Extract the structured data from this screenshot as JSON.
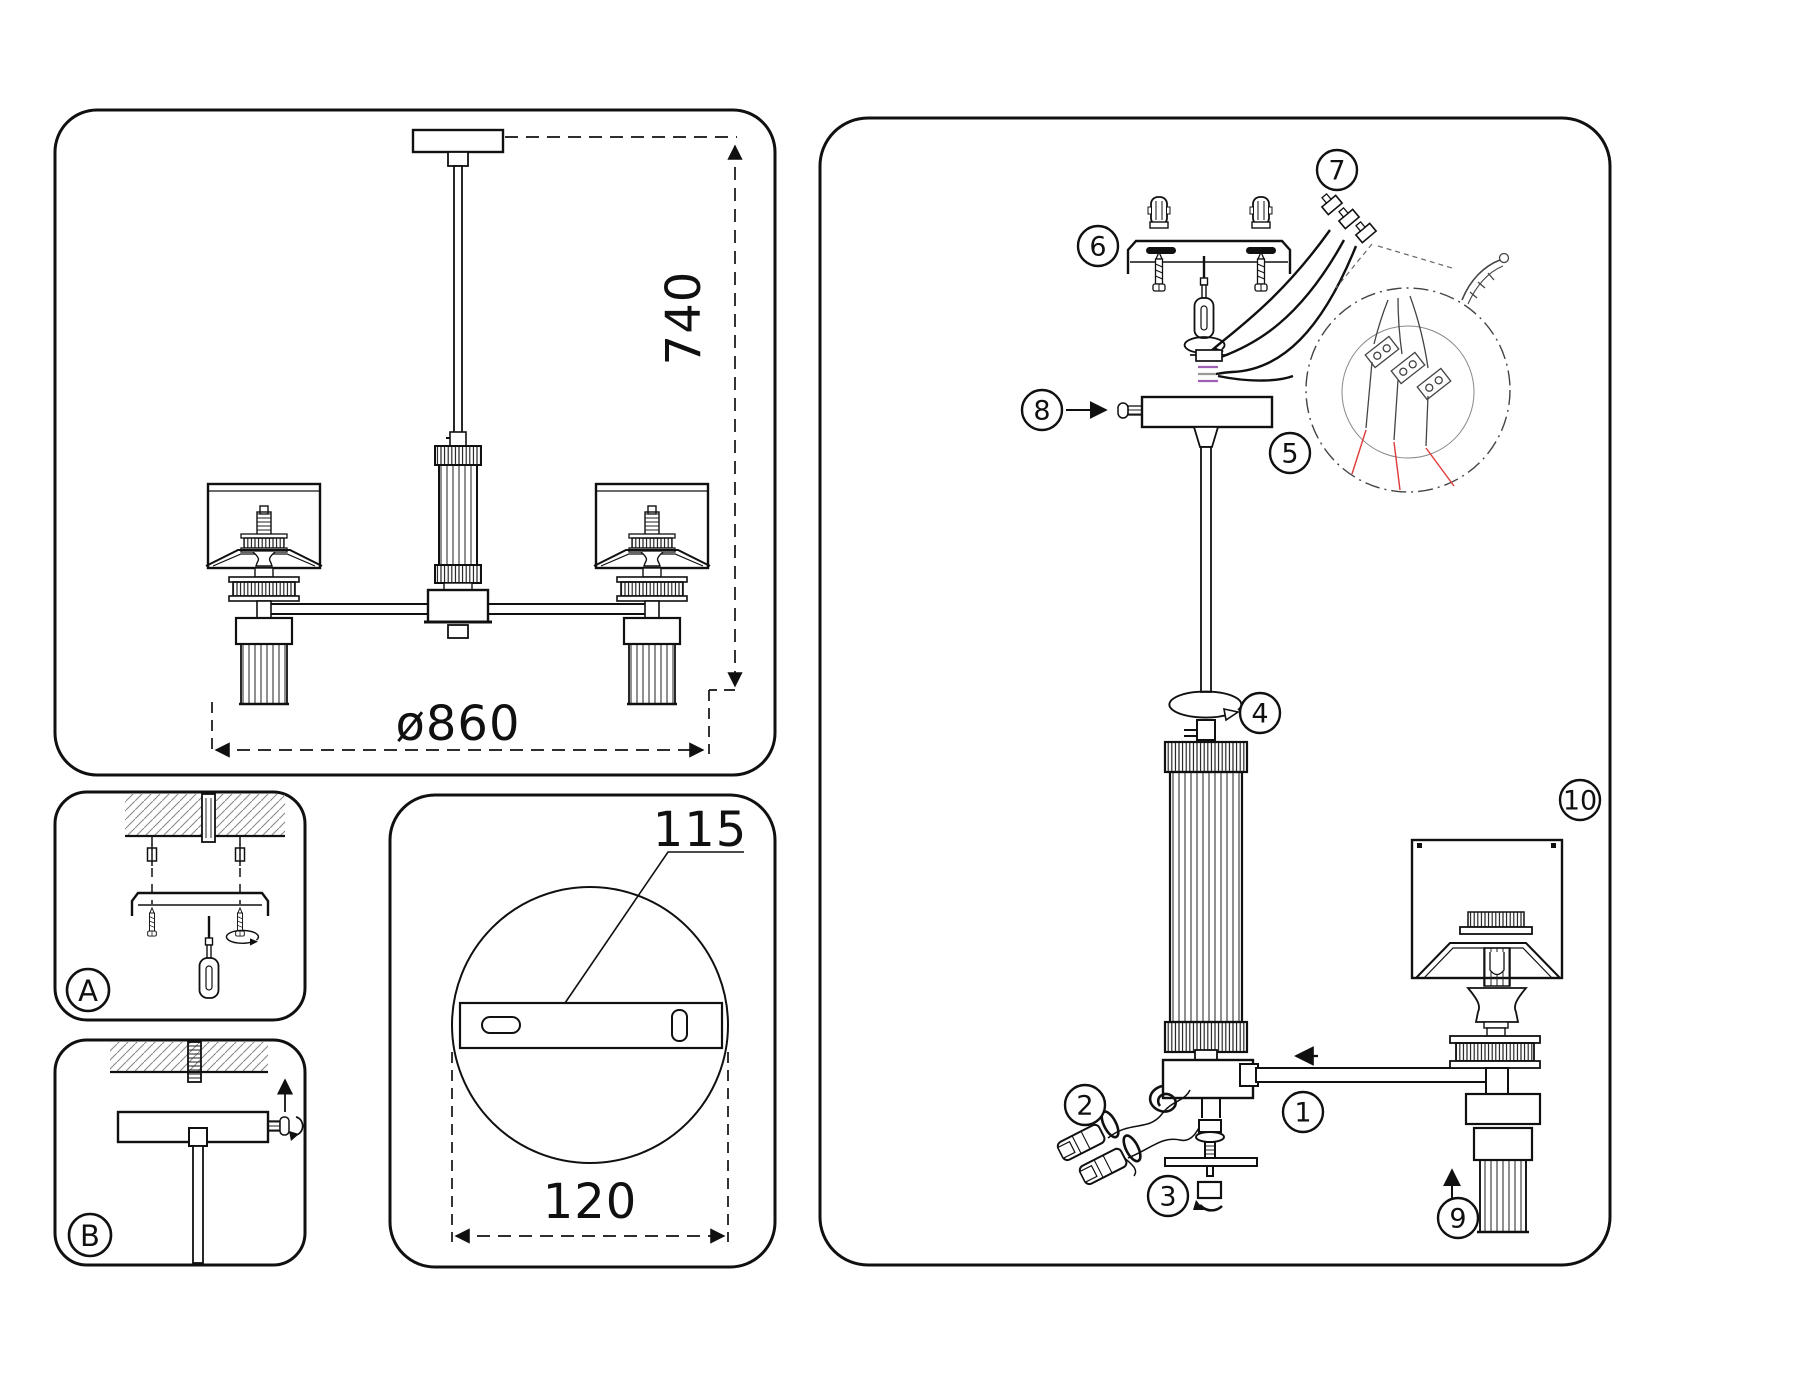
{
  "figure": {
    "type": "lighting fixture assembly instruction diagram",
    "background": "#ffffff",
    "line_color": "#101010",
    "accent_red": "#e03a3a",
    "accent_purple": "#9e5fb5",
    "hatch_gray": "#8a8a8a"
  },
  "panels": {
    "dimension_view": {
      "dim_height": "740",
      "dim_diameter": "ø860"
    },
    "step_a": {
      "label": "A"
    },
    "step_b": {
      "label": "B"
    },
    "bracket_detail": {
      "dim_bracket_length": "115",
      "dim_canopy_diameter": "120"
    },
    "assembly": {
      "callouts": [
        "1",
        "2",
        "3",
        "4",
        "5",
        "6",
        "7",
        "8",
        "9",
        "10"
      ]
    }
  }
}
